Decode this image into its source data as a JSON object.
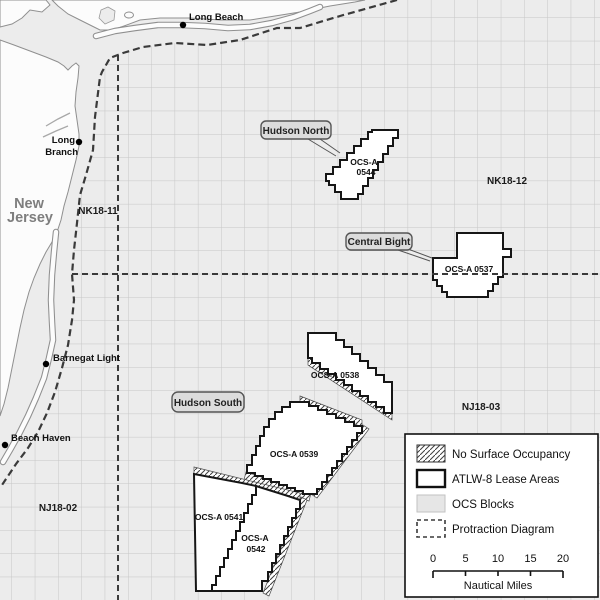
{
  "map": {
    "state_label": {
      "line1": "New",
      "line2": "Jersey"
    },
    "places": {
      "long_beach": "Long Beach",
      "long_branch_line1": "Long",
      "long_branch_line2": "Branch",
      "barnegat_light": "Barnegat Light",
      "beach_haven": "Beach Haven"
    },
    "protraction_areas": {
      "nk18_11": "NK18-11",
      "nk18_12": "NK18-12",
      "nj18_02": "NJ18-02",
      "nj18_03": "NJ18-03"
    },
    "callouts": {
      "hudson_north": "Hudson North",
      "central_bight": "Central Bight",
      "hudson_south": "Hudson South"
    },
    "lease_areas": {
      "a0544_line1": "OCS-A",
      "a0544_line2": "0544",
      "a0537": "OCS-A 0537",
      "a0538": "OCS-A 0538",
      "a0539": "OCS-A 0539",
      "a0541": "OCS-A 0541",
      "a0542_line1": "OCS-A",
      "a0542_line2": "0542"
    }
  },
  "legend": {
    "items": [
      {
        "label": "No Surface Occupancy",
        "swatch": "hatched"
      },
      {
        "label": "ATLW-8 Lease Areas",
        "swatch": "outlined-white"
      },
      {
        "label": "OCS Blocks",
        "swatch": "gray-fill"
      },
      {
        "label": "Protraction Diagram",
        "swatch": "dashed-outline"
      }
    ]
  },
  "scale_bar": {
    "ticks": [
      "0",
      "5",
      "10",
      "15",
      "20"
    ],
    "unit": "Nautical Miles"
  },
  "colors": {
    "water": "#ececec",
    "land": "#fcfcfc",
    "grid_line": "#c6c6c6",
    "lease_fill": "#ffffff",
    "lease_outline": "#161616",
    "boundary_dash": "#3a3a3a",
    "callout_fill": "#dcdcdc",
    "legend_bg": "#ffffff"
  }
}
